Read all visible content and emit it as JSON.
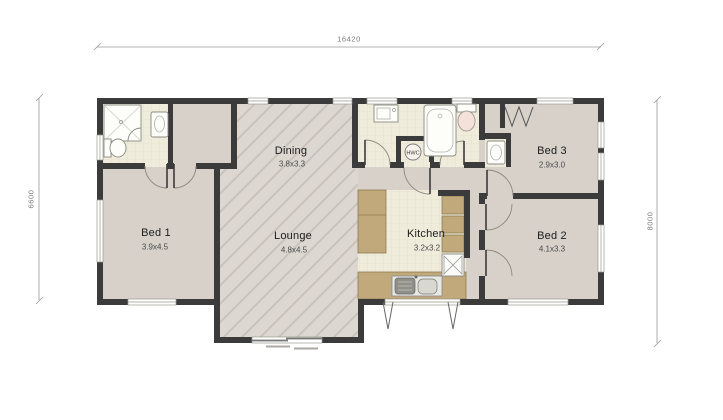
{
  "dimensions": {
    "overall_width": "16420",
    "left_height": "6600",
    "right_height": "8000"
  },
  "rooms": {
    "bed1": {
      "label": "Bed 1",
      "size": "3.9x4.5"
    },
    "dining": {
      "label": "Dining",
      "size": "3.8x3.3"
    },
    "lounge": {
      "label": "Lounge",
      "size": "4.8x4.5"
    },
    "kitchen": {
      "label": "Kitchen",
      "size": "3.2x3.2"
    },
    "bed3": {
      "label": "Bed 3",
      "size": "2.9x3.0"
    },
    "bed2": {
      "label": "Bed 2",
      "size": "4.1x3.3"
    },
    "hwc": {
      "label": "HWC"
    }
  },
  "fixtures": [
    "shower",
    "toilet",
    "vanity",
    "laundry-tub",
    "bathtub",
    "hot-water-cylinder",
    "kitchen-sink",
    "dishwasher",
    "pantry-cabinets",
    "wardrobe-bifold",
    "sliding-door",
    "deck-piles"
  ],
  "colors": {
    "wall": "#3b3b3b",
    "carpet": "#d7d1ca",
    "hatchBase": "#dcd7d0",
    "hatchLine": "#c8c1b8",
    "tile": "#efecdc",
    "tileLine": "#e0dcc5",
    "counter": "#c2a97c",
    "counterLine": "#8d7c52",
    "fixture": "#fdfdf9",
    "fixtureLine": "#8a8a82",
    "doorArc": "#8a887e",
    "windowLine": "#99998f",
    "dim": "#9a9a9a",
    "dimText": "#7a7a7a",
    "labelText": "#1c1c1c",
    "sizeText": "#4a4a4a",
    "toiletSeat": "#f5e0da"
  }
}
